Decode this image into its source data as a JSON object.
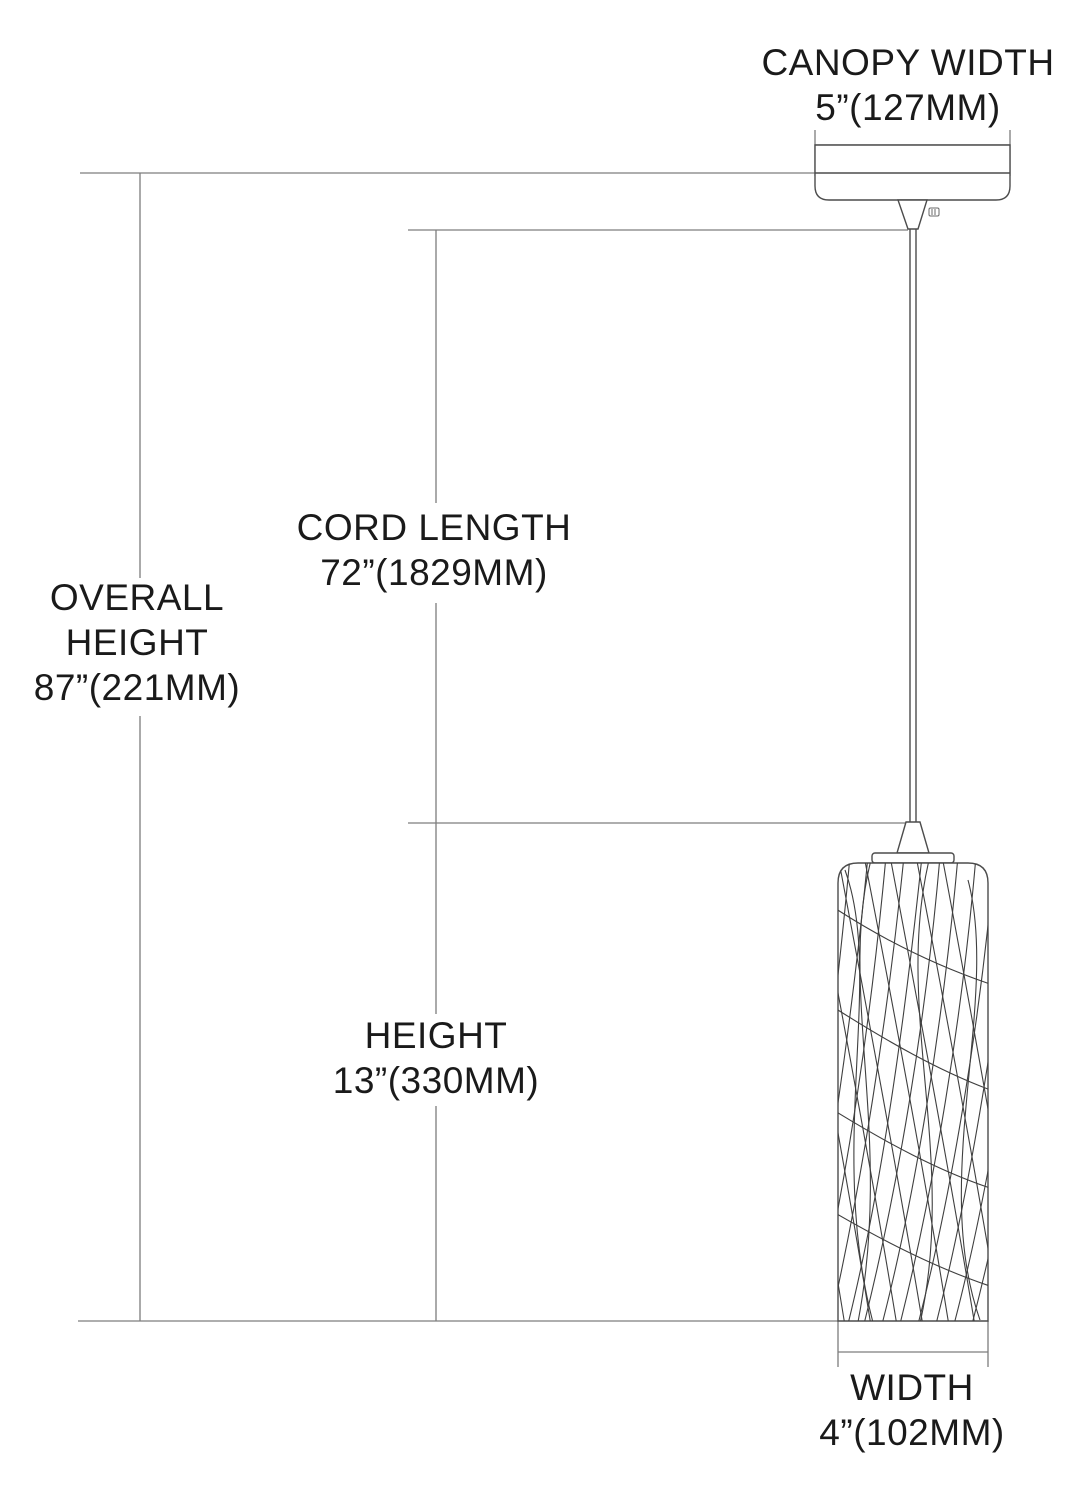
{
  "diagram": {
    "type": "pendant-light-dimension-drawing",
    "labels": {
      "canopy_width": {
        "title": "CANOPY WIDTH",
        "value": "5”(127MM)"
      },
      "overall_height": {
        "line1": "OVERALL",
        "line2": "HEIGHT",
        "value": "87”(221MM)"
      },
      "cord_length": {
        "title": "CORD LENGTH",
        "value": "72”(1829MM)"
      },
      "height": {
        "title": "HEIGHT",
        "value": "13”(330MM)"
      },
      "width": {
        "title": "WIDTH",
        "value": "4”(102MM)"
      }
    }
  },
  "colors": {
    "bg": "#ffffff",
    "text": "#1a1a1a",
    "dim": "#7d7d7d",
    "draw": "#4c4c4c",
    "pattern": "#3f3f3f"
  }
}
